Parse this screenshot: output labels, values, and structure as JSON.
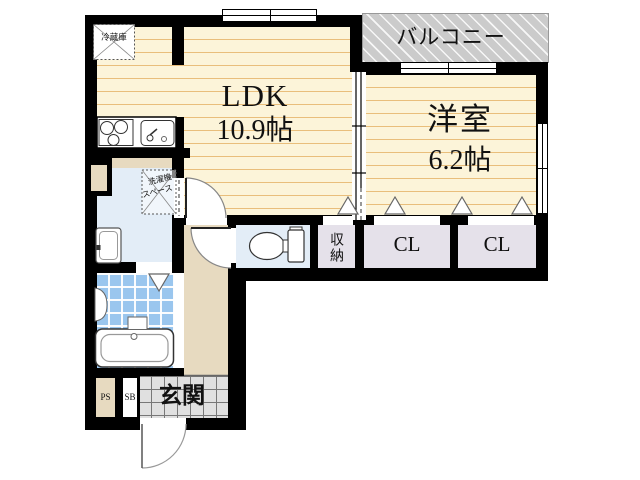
{
  "rooms": {
    "ldk": {
      "label": "LDK",
      "size": "10.9帖"
    },
    "western": {
      "label": "洋室",
      "size": "6.2帖"
    },
    "balcony": {
      "label": "バルコニー"
    },
    "closet_left": {
      "label": "CL"
    },
    "closet_right": {
      "label": "CL"
    },
    "storage": {
      "label": "収納"
    },
    "entrance": {
      "label": "玄関"
    },
    "pipe_space": {
      "label": "PS"
    },
    "shoe_box": {
      "label": "SB"
    },
    "refrigerator": {
      "label": "冷蔵庫"
    },
    "washer_space": {
      "line1": "洗濯機",
      "line2": "スペース"
    }
  },
  "colors": {
    "wall": "#000000",
    "floor": "#FCF4D9",
    "floor_stripe": "#E9BE7B",
    "balcony_bg": "#CBCBCB",
    "wet_bg": "#E3EDF7",
    "bath_tile": "#9AC6EE",
    "hall_bg": "#E7DAC0",
    "closet_bg": "#E5E1EA",
    "entrance_tile": "#E0E0E0"
  }
}
